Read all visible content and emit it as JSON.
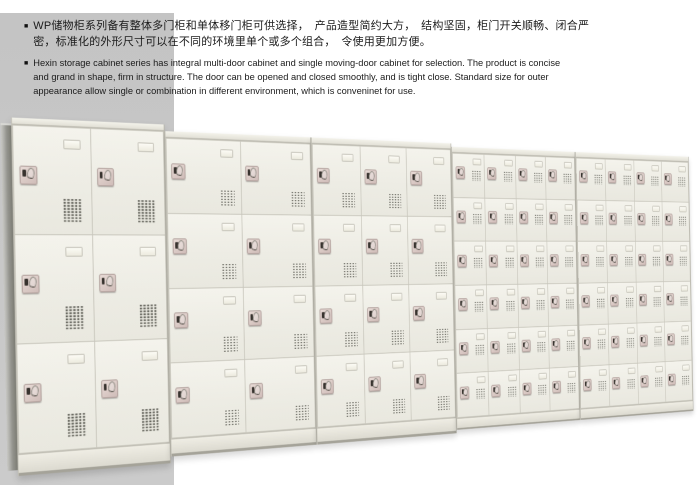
{
  "intro": {
    "bullet": "■",
    "zh_text": "WP储物柜系列备有整体多门柜和单体移门柜可供选择，　产品造型简约大方，　结构坚固，柜门开关顺畅、闭合严\n密，标准化的外形尺寸可以在不同的环境里单个或多个组合，　令使用更加方便。",
    "en_text": "Hexin storage cabinet series has integral multi-door cabinet and single moving-door cabinet for selection. The product is concise\nand grand in shape, firm in structure. The door can be opened and closed smoothly, and is tight close. Standard size for outer\nappearance allow single or combination in different environment, which is conveninet for use."
  },
  "photo": {
    "description": "Bank of WP storage locker cabinets shown in perspective, receding to the right",
    "colors": {
      "backdrop": "#c6c6c6",
      "cabinet_face": "#f1f0e8",
      "seam": "#c8c6bc",
      "side_panel": "#95958f",
      "lock_pad": "#d8c7c2",
      "lock_key": "#38332f",
      "vent_dash": "#56564e"
    },
    "cabinets": [
      {
        "name": "two-col-three-row",
        "cols": 2,
        "rows": 3,
        "width": 170,
        "height": 360,
        "size": "lg"
      },
      {
        "name": "two-col-four-row",
        "cols": 2,
        "rows": 4,
        "width": 182,
        "height": 346,
        "size": "md"
      },
      {
        "name": "three-col-four-row",
        "cols": 3,
        "rows": 4,
        "width": 196,
        "height": 346,
        "size": "md"
      },
      {
        "name": "four-col-six-row",
        "cols": 4,
        "rows": 6,
        "width": 194,
        "height": 338,
        "size": "sm"
      },
      {
        "name": "four-col-six-row-far",
        "cols": 4,
        "rows": 6,
        "width": 198,
        "height": 338,
        "size": "sm"
      }
    ]
  }
}
